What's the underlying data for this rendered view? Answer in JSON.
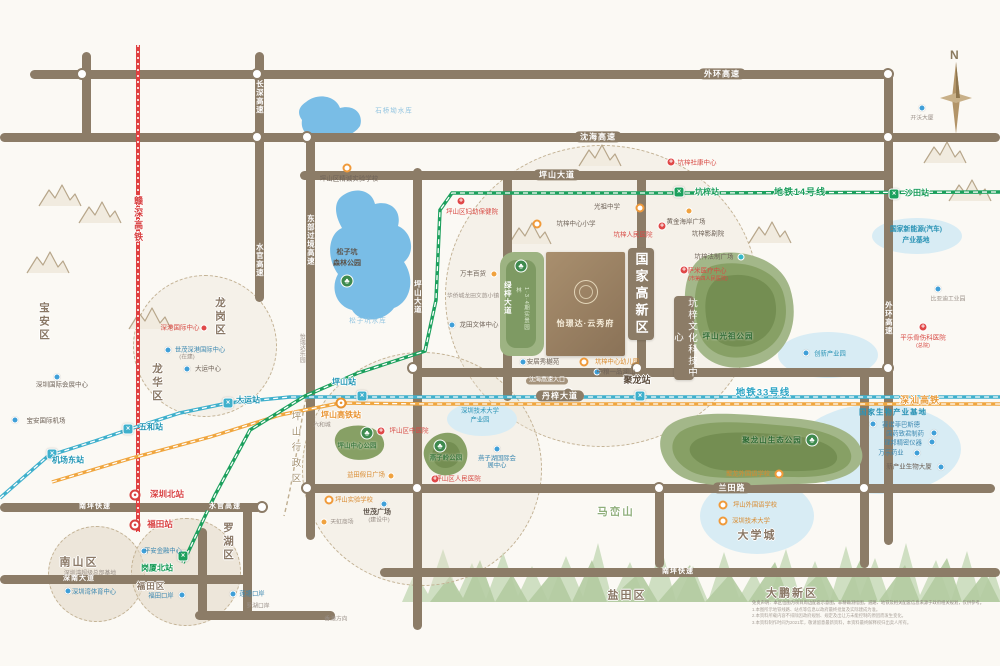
{
  "compass": {
    "north": "N"
  },
  "project": {
    "name": "怡璟达·云秀府",
    "strip_label": "1·3·4期实景园林"
  },
  "banners": {
    "gaoxin": "国家高新区",
    "keji": "坑梓文化科技中心"
  },
  "colors": {
    "road": "#8c7c67",
    "metro14": "#1ca05d",
    "metro33": "#3fb0cc",
    "shenshan_hsr": "#f0a63f",
    "ganshen_hsr": "#e04040",
    "water": "#79bde6",
    "park": "#87a065",
    "boundary": "#bfae90"
  },
  "rail_lines": [
    {
      "name": "地铁14号线",
      "color": "#1ca05d"
    },
    {
      "name": "地铁33号线",
      "color": "#3fb0cc"
    },
    {
      "name": "深汕高铁",
      "color": "#f0a63f"
    },
    {
      "name": "赣深高铁",
      "color": "#e04040"
    }
  ],
  "labels": [
    {
      "t": "外环高速",
      "x": 722,
      "y": 74,
      "c": "rb",
      "n": "road-label"
    },
    {
      "t": "沈海高速",
      "x": 598,
      "y": 137,
      "c": "rb",
      "n": "road-label"
    },
    {
      "t": "坪山大道",
      "x": 557,
      "y": 175,
      "c": "rb",
      "n": "road-label"
    },
    {
      "t": "丹梓大道",
      "x": 560,
      "y": 396,
      "c": "rb",
      "n": "road-label"
    },
    {
      "t": "兰田路",
      "x": 732,
      "y": 488,
      "c": "rb",
      "n": "road-label"
    },
    {
      "t": "南坪快速",
      "x": 95,
      "y": 507,
      "c": "rbs",
      "n": "road-label"
    },
    {
      "t": "水官高速",
      "x": 225,
      "y": 507,
      "c": "rbs",
      "n": "road-label"
    },
    {
      "t": "南坪快速",
      "x": 678,
      "y": 572,
      "c": "rbs",
      "n": "road-label"
    },
    {
      "t": "深南大道",
      "x": 79,
      "y": 579,
      "c": "rbs",
      "n": "road-label"
    },
    {
      "t": "长深高速",
      "x": 259,
      "y": 97,
      "c": "rv-l",
      "v": 1,
      "n": "road-label"
    },
    {
      "t": "水官高速",
      "x": 259,
      "y": 260,
      "c": "rv-l",
      "v": 1,
      "n": "road-label"
    },
    {
      "t": "东部过境高速",
      "x": 310,
      "y": 240,
      "c": "rv-l",
      "v": 1,
      "n": "road-label"
    },
    {
      "t": "坪山大道",
      "x": 417,
      "y": 297,
      "c": "rv-l",
      "v": 1,
      "n": "road-label"
    },
    {
      "t": "绿梓大道",
      "x": 507,
      "y": 298,
      "c": "rv-l",
      "v": 1,
      "n": "road-label"
    },
    {
      "t": "外环高速",
      "x": 888,
      "y": 318,
      "c": "rv-l",
      "v": 1,
      "n": "road-label"
    },
    {
      "t": "宝安区",
      "x": 44,
      "y": 322,
      "c": "regv ow",
      "v": 1,
      "n": "district-label"
    },
    {
      "t": "龙华区",
      "x": 157,
      "y": 383,
      "c": "regv ow",
      "v": 1,
      "n": "district-label"
    },
    {
      "t": "龙岗区",
      "x": 220,
      "y": 317,
      "c": "regv ow",
      "v": 1,
      "n": "district-label"
    },
    {
      "t": "罗湖区",
      "x": 228,
      "y": 542,
      "c": "regv ow",
      "v": 1,
      "n": "district-label"
    },
    {
      "t": "坪山行政区",
      "x": 294,
      "y": 450,
      "c": "bndv ow",
      "v": 1,
      "n": "district-label"
    },
    {
      "t": "南山区",
      "x": 79,
      "y": 563,
      "c": "reg ow",
      "n": "district-label"
    },
    {
      "t": "福田区",
      "x": 151,
      "y": 587,
      "c": "regsm ow",
      "n": "district-label"
    },
    {
      "t": "盐田区",
      "x": 627,
      "y": 596,
      "c": "reg ow",
      "n": "district-label"
    },
    {
      "t": "大鹏新区",
      "x": 792,
      "y": 594,
      "c": "reg ow",
      "n": "district-label"
    },
    {
      "t": "马峦山",
      "x": 616,
      "y": 512,
      "c": "mtn-l ow",
      "n": "mountain-label"
    },
    {
      "t": "大学城",
      "x": 757,
      "y": 536,
      "c": "reg ow",
      "n": "district-label"
    },
    {
      "t": "地铁14号线",
      "x": 800,
      "y": 192,
      "c": "lng ow",
      "n": "rail-line-label"
    },
    {
      "t": "地铁33号线",
      "x": 763,
      "y": 394,
      "c": "lnt ow",
      "n": "rail-line-label"
    },
    {
      "t": "深汕高铁",
      "x": 920,
      "y": 400,
      "c": "lno ow",
      "n": "rail-line-label"
    },
    {
      "t": "赣深高铁",
      "x": 138,
      "y": 220,
      "c": "lnr ow",
      "v": 1,
      "n": "rail-line-label"
    },
    {
      "t": "坑梓站",
      "x": 707,
      "y": 192,
      "c": "stg ow",
      "n": "station-label"
    },
    {
      "t": "沙田站",
      "x": 917,
      "y": 193,
      "c": "stg ow",
      "n": "station-label"
    },
    {
      "t": "岗厦北站",
      "x": 157,
      "y": 568,
      "c": "stg ow",
      "n": "station-label"
    },
    {
      "t": "坪山站",
      "x": 344,
      "y": 382,
      "c": "stt ow",
      "n": "station-label"
    },
    {
      "t": "大运站",
      "x": 248,
      "y": 400,
      "c": "stt ow",
      "n": "station-label"
    },
    {
      "t": "五和站",
      "x": 151,
      "y": 427,
      "c": "stt ow",
      "n": "station-label"
    },
    {
      "t": "机场东站",
      "x": 68,
      "y": 460,
      "c": "stt ow",
      "n": "station-label"
    },
    {
      "t": "聚龙站",
      "x": 637,
      "y": 380,
      "c": "stk ow",
      "n": "station-label"
    },
    {
      "t": "深圳北站",
      "x": 167,
      "y": 495,
      "c": "str ow",
      "n": "station-label"
    },
    {
      "t": "福田站",
      "x": 160,
      "y": 525,
      "c": "str ow",
      "n": "station-label"
    },
    {
      "t": "坪山高铁站",
      "x": 341,
      "y": 415,
      "c": "sto ow",
      "n": "station-label"
    },
    {
      "t": "光祖中学",
      "x": 607,
      "y": 207,
      "c": "poi",
      "n": "school-label"
    },
    {
      "t": "坑梓中心小学",
      "x": 576,
      "y": 224,
      "c": "poi",
      "n": "school-label"
    },
    {
      "t": "坑梓人民医院",
      "x": 633,
      "y": 235,
      "c": "poir",
      "n": "hospital-label"
    },
    {
      "t": "黄金海岸广场",
      "x": 686,
      "y": 222,
      "c": "poi",
      "n": "poi-label"
    },
    {
      "t": "坑梓影剧院",
      "x": 708,
      "y": 234,
      "c": "poi",
      "n": "poi-label"
    },
    {
      "t": "坑梓法制广场",
      "x": 714,
      "y": 257,
      "c": "poi",
      "n": "poi-label"
    },
    {
      "t": "萨米医疗中心",
      "x": 707,
      "y": 271,
      "c": "poir",
      "n": "hospital-label"
    },
    {
      "t": "(市第四人民医院)",
      "x": 708,
      "y": 280,
      "c": "poirs",
      "n": "hospital-label"
    },
    {
      "t": "坪山区妇幼保健院",
      "x": 472,
      "y": 212,
      "c": "poir",
      "n": "hospital-label"
    },
    {
      "t": "坪山区精诚实验学校",
      "x": 349,
      "y": 179,
      "c": "poi",
      "n": "school-label"
    },
    {
      "t": "万丰百货",
      "x": 473,
      "y": 274,
      "c": "poi",
      "n": "poi-label"
    },
    {
      "t": "华侨城龙田文旅小镇",
      "x": 473,
      "y": 297,
      "c": "pois",
      "n": "poi-label"
    },
    {
      "t": "龙田文体中心",
      "x": 479,
      "y": 325,
      "c": "poi",
      "n": "poi-label"
    },
    {
      "t": "坑梓中心幼儿园",
      "x": 617,
      "y": 362,
      "c": "poio",
      "n": "school-label"
    },
    {
      "t": "安居秀樾苑",
      "x": 543,
      "y": 362,
      "c": "poi",
      "n": "poi-label"
    },
    {
      "t": "中粮一品澜山",
      "x": 616,
      "y": 372,
      "c": "poi",
      "n": "poi-label"
    },
    {
      "t": "沈海高速入口",
      "x": 547,
      "y": 381,
      "c": "entry-t",
      "n": "road-entry-label"
    },
    {
      "t": "松子坑",
      "x": 347,
      "y": 253,
      "c": "dark7",
      "n": "park-label"
    },
    {
      "t": "森林公园",
      "x": 347,
      "y": 264,
      "c": "dark7",
      "n": "park-label"
    },
    {
      "t": "松子坑水库",
      "x": 368,
      "y": 321,
      "c": "lake-l",
      "n": "lake-label"
    },
    {
      "t": "石桥坳水库",
      "x": 394,
      "y": 111,
      "c": "lake-l",
      "n": "lake-label"
    },
    {
      "t": "怡瑞达乐园",
      "x": 301,
      "y": 348,
      "c": "pois",
      "v": 1,
      "n": "poi-label"
    },
    {
      "t": "坪山光祖公园",
      "x": 728,
      "y": 337,
      "c": "park-l",
      "n": "park-label"
    },
    {
      "t": "聚龙山生态公园",
      "x": 772,
      "y": 441,
      "c": "park-l",
      "n": "park-label"
    },
    {
      "t": "燕子岭公园",
      "x": 446,
      "y": 458,
      "c": "park-ls",
      "n": "park-label"
    },
    {
      "t": "坪山中心公园",
      "x": 357,
      "y": 446,
      "c": "park-ls",
      "n": "park-label"
    },
    {
      "t": "坪山区中医院",
      "x": 409,
      "y": 431,
      "c": "poir",
      "n": "hospital-label"
    },
    {
      "t": "深圳技术大学",
      "x": 480,
      "y": 411,
      "c": "ell-t2",
      "n": "industry-zone-label"
    },
    {
      "t": "产业园",
      "x": 480,
      "y": 420,
      "c": "ell-t2",
      "n": "industry-zone-label"
    },
    {
      "t": "燕子湖国际会展中心",
      "x": 497,
      "y": 462,
      "c": "poib",
      "w": 42,
      "n": "poi-label"
    },
    {
      "t": "坪山区人民医院",
      "x": 458,
      "y": 479,
      "c": "poir",
      "n": "hospital-label"
    },
    {
      "t": "坪山实验学校",
      "x": 354,
      "y": 500,
      "c": "poio",
      "n": "school-label"
    },
    {
      "t": "益田假日广场",
      "x": 366,
      "y": 475,
      "c": "poio",
      "n": "poi-label"
    },
    {
      "t": "世茂广场",
      "x": 377,
      "y": 513,
      "c": "dark7",
      "n": "poi-label"
    },
    {
      "t": "(建设中)",
      "x": 379,
      "y": 521,
      "c": "pois",
      "n": "poi-label"
    },
    {
      "t": "天虹商场",
      "x": 342,
      "y": 523,
      "c": "pois",
      "n": "poi-label"
    },
    {
      "t": "深港国际中心",
      "x": 180,
      "y": 328,
      "c": "poir",
      "n": "poi-label"
    },
    {
      "t": "世茂深港国际中心",
      "x": 200,
      "y": 350,
      "c": "poib",
      "n": "poi-label"
    },
    {
      "t": "(在建)",
      "x": 187,
      "y": 358,
      "c": "pois",
      "n": "poi-label"
    },
    {
      "t": "大运中心",
      "x": 208,
      "y": 369,
      "c": "poi",
      "n": "poi-label"
    },
    {
      "t": "深圳国际会展中心",
      "x": 62,
      "y": 385,
      "c": "poi",
      "n": "poi-label"
    },
    {
      "t": "宝安国际机场",
      "x": 46,
      "y": 421,
      "c": "poi",
      "n": "poi-label"
    },
    {
      "t": "深圳湾体育中心",
      "x": 94,
      "y": 592,
      "c": "poib",
      "n": "poi-label"
    },
    {
      "t": "深圳湾超级总部基地",
      "x": 90,
      "y": 574,
      "c": "pois",
      "n": "poi-label"
    },
    {
      "t": "平安金融中心",
      "x": 163,
      "y": 551,
      "c": "poib",
      "n": "poi-label"
    },
    {
      "t": "福田口岸",
      "x": 161,
      "y": 596,
      "c": "poib",
      "n": "poi-label"
    },
    {
      "t": "莲塘口岸",
      "x": 252,
      "y": 594,
      "c": "poib",
      "n": "poi-label"
    },
    {
      "t": "罗湖口岸",
      "x": 258,
      "y": 607,
      "c": "pois",
      "n": "poi-label"
    },
    {
      "t": "香港方向",
      "x": 336,
      "y": 620,
      "c": "pois",
      "n": "direction-label"
    },
    {
      "t": "国家新能源(汽车)",
      "x": 916,
      "y": 230,
      "c": "ell-t",
      "n": "industry-zone-label"
    },
    {
      "t": "产业基地",
      "x": 916,
      "y": 241,
      "c": "ell-t",
      "n": "industry-zone-label"
    },
    {
      "t": "比亚迪工业园",
      "x": 948,
      "y": 300,
      "c": "pois",
      "n": "poi-label"
    },
    {
      "t": "创新产业园",
      "x": 830,
      "y": 354,
      "c": "ell-t2",
      "n": "industry-zone-label"
    },
    {
      "t": "平乐骨伤科医院",
      "x": 923,
      "y": 338,
      "c": "poir",
      "n": "hospital-label"
    },
    {
      "t": "(总院)",
      "x": 923,
      "y": 347,
      "c": "poirs",
      "n": "hospital-label"
    },
    {
      "t": "国家生物产业基地",
      "x": 893,
      "y": 413,
      "c": "bio-t",
      "n": "industry-zone-label"
    },
    {
      "t": "赛诺菲巴斯德",
      "x": 901,
      "y": 425,
      "c": "poib",
      "n": "poi-label"
    },
    {
      "t": "国药致君制药",
      "x": 905,
      "y": 434,
      "c": "poib",
      "n": "poi-label"
    },
    {
      "t": "理邦精密仪器",
      "x": 903,
      "y": 443,
      "c": "poib",
      "n": "poi-label"
    },
    {
      "t": "万乐药业",
      "x": 891,
      "y": 453,
      "c": "poib",
      "n": "poi-label"
    },
    {
      "t": "新产业生物大厦",
      "x": 909,
      "y": 467,
      "c": "poi",
      "n": "poi-label"
    },
    {
      "t": "坪山外国语学校",
      "x": 755,
      "y": 505,
      "c": "poio",
      "n": "school-label"
    },
    {
      "t": "深圳技术大学",
      "x": 751,
      "y": 521,
      "c": "poio",
      "n": "school-label"
    },
    {
      "t": "聚龙外国语学校",
      "x": 748,
      "y": 474,
      "c": "poio",
      "n": "school-label"
    },
    {
      "t": "开沃大厦",
      "x": 922,
      "y": 119,
      "c": "pois",
      "n": "poi-label"
    },
    {
      "t": "坑梓社康中心",
      "x": 697,
      "y": 163,
      "c": "poir",
      "n": "hospital-label"
    },
    {
      "t": "六和城",
      "x": 322,
      "y": 426,
      "c": "pois",
      "n": "poi-label"
    }
  ],
  "markers": [
    {
      "k": "xg",
      "x": 679,
      "y": 192
    },
    {
      "k": "xg",
      "x": 894,
      "y": 194
    },
    {
      "k": "xg",
      "x": 183,
      "y": 556
    },
    {
      "k": "xt",
      "x": 362,
      "y": 396
    },
    {
      "k": "xt",
      "x": 228,
      "y": 403
    },
    {
      "k": "xt",
      "x": 128,
      "y": 429
    },
    {
      "k": "xt",
      "x": 52,
      "y": 454
    },
    {
      "k": "xt",
      "x": 640,
      "y": 396
    },
    {
      "k": "hr",
      "x": 135,
      "y": 495
    },
    {
      "k": "hr",
      "x": 135,
      "y": 525
    },
    {
      "k": "ho",
      "x": 341,
      "y": 403
    },
    {
      "k": "sch",
      "x": 640,
      "y": 208
    },
    {
      "k": "sch",
      "x": 537,
      "y": 224
    },
    {
      "k": "sch",
      "x": 347,
      "y": 168
    },
    {
      "k": "sch",
      "x": 584,
      "y": 362
    },
    {
      "k": "sch",
      "x": 723,
      "y": 505
    },
    {
      "k": "sch",
      "x": 723,
      "y": 521
    },
    {
      "k": "sch",
      "x": 779,
      "y": 474
    },
    {
      "k": "sch",
      "x": 329,
      "y": 500
    },
    {
      "k": "hos",
      "x": 662,
      "y": 226
    },
    {
      "k": "hos",
      "x": 684,
      "y": 270
    },
    {
      "k": "hos",
      "x": 461,
      "y": 201
    },
    {
      "k": "hos",
      "x": 381,
      "y": 431
    },
    {
      "k": "hos",
      "x": 435,
      "y": 479
    },
    {
      "k": "hos",
      "x": 923,
      "y": 327
    },
    {
      "k": "hos",
      "x": 671,
      "y": 162
    },
    {
      "k": "blu",
      "x": 452,
      "y": 325
    },
    {
      "k": "blu",
      "x": 523,
      "y": 362
    },
    {
      "k": "blu",
      "x": 597,
      "y": 372
    },
    {
      "k": "blu",
      "x": 57,
      "y": 377
    },
    {
      "k": "blu",
      "x": 15,
      "y": 420
    },
    {
      "k": "blu",
      "x": 168,
      "y": 350
    },
    {
      "k": "blu",
      "x": 187,
      "y": 369
    },
    {
      "k": "blu",
      "x": 144,
      "y": 551
    },
    {
      "k": "blu",
      "x": 68,
      "y": 591
    },
    {
      "k": "blu",
      "x": 182,
      "y": 595
    },
    {
      "k": "blu",
      "x": 233,
      "y": 594
    },
    {
      "k": "blu",
      "x": 384,
      "y": 504
    },
    {
      "k": "blu",
      "x": 497,
      "y": 449
    },
    {
      "k": "blu",
      "x": 806,
      "y": 353
    },
    {
      "k": "blu",
      "x": 873,
      "y": 424
    },
    {
      "k": "blu",
      "x": 934,
      "y": 433
    },
    {
      "k": "blu",
      "x": 932,
      "y": 442
    },
    {
      "k": "blu",
      "x": 917,
      "y": 453
    },
    {
      "k": "blu",
      "x": 941,
      "y": 467
    },
    {
      "k": "blu",
      "x": 938,
      "y": 289
    },
    {
      "k": "blu",
      "x": 922,
      "y": 108
    },
    {
      "k": "cyn",
      "x": 741,
      "y": 257
    },
    {
      "k": "org",
      "x": 689,
      "y": 211
    },
    {
      "k": "org",
      "x": 494,
      "y": 274
    },
    {
      "k": "org",
      "x": 391,
      "y": 476
    },
    {
      "k": "org",
      "x": 324,
      "y": 522
    },
    {
      "k": "red",
      "x": 204,
      "y": 328
    },
    {
      "k": "tree",
      "x": 347,
      "y": 281
    },
    {
      "k": "tree",
      "x": 812,
      "y": 440
    },
    {
      "k": "tree",
      "x": 440,
      "y": 446
    },
    {
      "k": "tree",
      "x": 367,
      "y": 433
    },
    {
      "k": "tree",
      "x": 521,
      "y": 266
    },
    {
      "k": "ent",
      "x": 568,
      "y": 393
    }
  ],
  "disclaimer": {
    "lines": [
      "免责声明：本区位图为项目周边配套示意图，非精确测绘图，道路、地铁及相关配套信息来源于政府相关规划，仅供参考。",
      "1.本图所示地铁线路、站点等信息以政府最终批复及实际建成为准。",
      "2.本资料所载内容不排除因政府规划、规定及出让方未能控制的原因而发生变化。",
      "3.本资料制作时间为2021年，敬请留意最新资料，本资料最终解释权归出卖人所有。"
    ]
  }
}
